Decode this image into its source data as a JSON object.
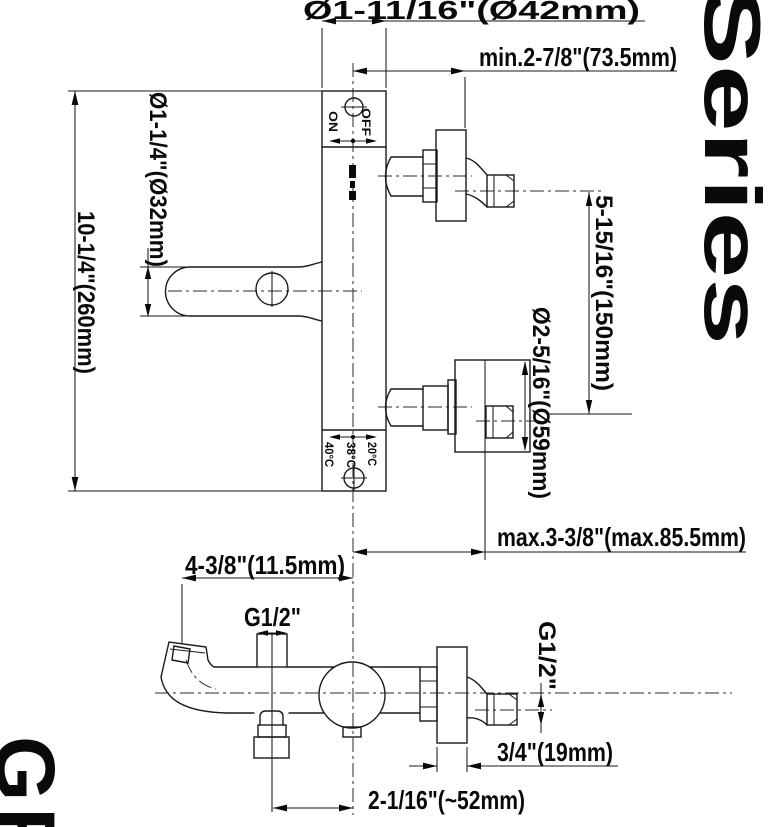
{
  "sheet": {
    "series_label": "Series",
    "logo_text": "GF"
  },
  "top_view": {
    "dim_plate_width": "Ø1-11/16\"(Ø42mm)",
    "dim_min_depth": "min.2-7/8\"(73.5mm)",
    "dim_handle_dia": "Ø1-1/4\"(Ø32mm)",
    "dim_height": "10-1/4\"(260mm)",
    "dim_port_spacing": "5-15/16\"(150mm)",
    "dim_flange_dia": "Ø2-5/16\"(Ø59mm)",
    "dim_max_depth": "max.3-3/8\"(max.85.5mm)",
    "label_on": "ON",
    "label_off": "OFF",
    "label_temp_hot": "40°C",
    "label_temp_mid": "38°C",
    "label_temp_cold": "20°C"
  },
  "bottom_view": {
    "dim_spout_reach": "4-3/8\"(11.5mm)",
    "label_inlet_thread": "G1/2\"",
    "label_outlet_thread": "G1/2\"",
    "dim_plate_thickness": "3/4\"(19mm)",
    "dim_outlet_offset": "2-1/16\"(~52mm)"
  }
}
